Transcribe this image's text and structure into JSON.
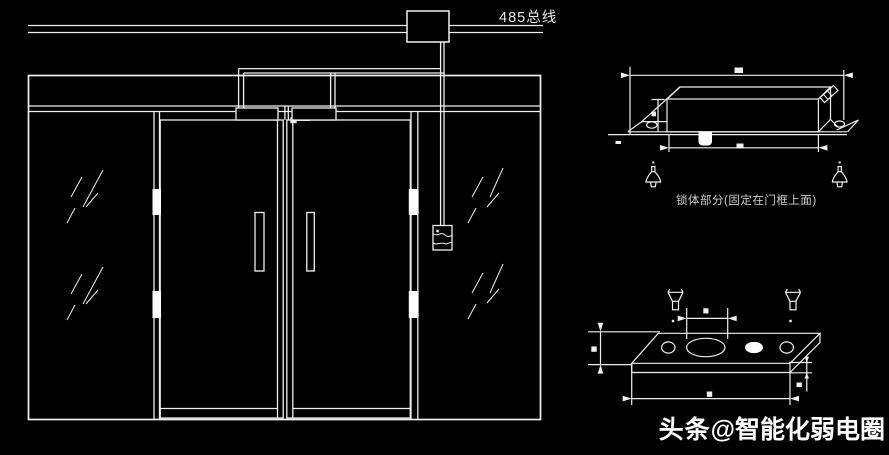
{
  "colors": {
    "background": "#000000",
    "line": "#f0f0f0",
    "text": "#ffffff"
  },
  "bus": {
    "label": "485总线"
  },
  "lock_side_view": {
    "caption": "锁体部分(固定在门框上面)"
  },
  "watermark": {
    "brand": "头条",
    "handle": "@智能化弱电圈"
  }
}
